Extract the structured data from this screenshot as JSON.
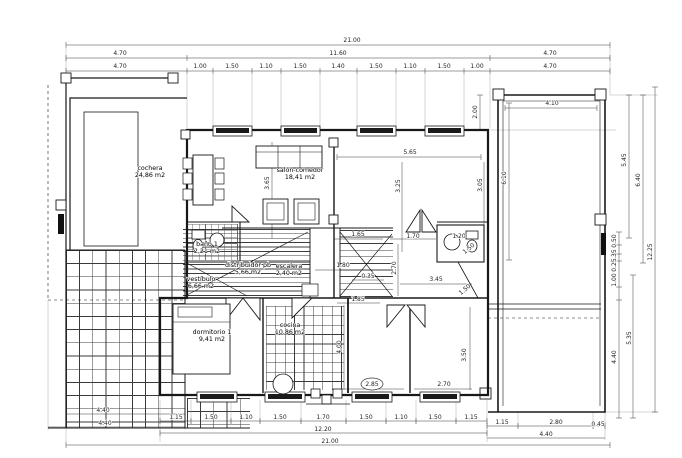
{
  "drawing": {
    "kind": "architectural floor plan, ground floor (planta baja)",
    "line_color": "#181818",
    "background": "#ffffff"
  },
  "rooms": [
    {
      "name": "cochera",
      "area": "24,86 m2",
      "x": 150,
      "y": 170
    },
    {
      "name": "salón-comedor",
      "area": "18,41 m2",
      "x": 300,
      "y": 172
    },
    {
      "name": "baño 1",
      "area": "2,21 m2",
      "x": 207,
      "y": 246
    },
    {
      "name": "distribuidor pb",
      "area": "5,66 m2",
      "x": 248,
      "y": 267
    },
    {
      "name": "vestíbulo",
      "area": "6,66 m2",
      "x": 201,
      "y": 281
    },
    {
      "name": "escalera",
      "area": "2,40 m2",
      "x": 289,
      "y": 268
    },
    {
      "name": "dormitorio 1",
      "area": "9,41 m2",
      "x": 212,
      "y": 334
    },
    {
      "name": "cocina",
      "area": "10,86 m2",
      "x": 290,
      "y": 327
    }
  ],
  "dimension_labels": [
    {
      "t": "21.00",
      "x": 352,
      "y": 42
    },
    {
      "t": "4.70",
      "x": 120,
      "y": 55
    },
    {
      "t": "11.60",
      "x": 338,
      "y": 55
    },
    {
      "t": "4.70",
      "x": 550,
      "y": 55
    },
    {
      "t": "4.70",
      "x": 120,
      "y": 68
    },
    {
      "t": "1.00",
      "x": 200,
      "y": 68
    },
    {
      "t": "1.50",
      "x": 232,
      "y": 68
    },
    {
      "t": "1.10",
      "x": 266,
      "y": 68
    },
    {
      "t": "1.50",
      "x": 300,
      "y": 68
    },
    {
      "t": "1.40",
      "x": 338,
      "y": 68
    },
    {
      "t": "1.50",
      "x": 376,
      "y": 68
    },
    {
      "t": "1.10",
      "x": 410,
      "y": 68
    },
    {
      "t": "1.50",
      "x": 444,
      "y": 68
    },
    {
      "t": "1.00",
      "x": 477,
      "y": 68
    },
    {
      "t": "4.70",
      "x": 550,
      "y": 68
    },
    {
      "t": "2.00",
      "x": 477,
      "y": 112,
      "r": 1
    },
    {
      "t": "4.10",
      "x": 552,
      "y": 105
    },
    {
      "t": "6.10",
      "x": 506,
      "y": 178,
      "r": 1
    },
    {
      "t": "5.45",
      "x": 626,
      "y": 160,
      "r": 1
    },
    {
      "t": "6.40",
      "x": 640,
      "y": 180,
      "r": 1
    },
    {
      "t": "12.25",
      "x": 652,
      "y": 252,
      "r": 1
    },
    {
      "t": "0.50",
      "x": 616,
      "y": 241,
      "r": 1
    },
    {
      "t": "0.35",
      "x": 616,
      "y": 256,
      "r": 1
    },
    {
      "t": "0.25",
      "x": 616,
      "y": 265,
      "r": 1
    },
    {
      "t": "1.00",
      "x": 616,
      "y": 280,
      "r": 1
    },
    {
      "t": "5.35",
      "x": 631,
      "y": 338,
      "r": 1
    },
    {
      "t": "4.40",
      "x": 616,
      "y": 357,
      "r": 1
    },
    {
      "t": "5.65",
      "x": 410,
      "y": 154
    },
    {
      "t": "3.65",
      "x": 269,
      "y": 183,
      "r": 1
    },
    {
      "t": "3.25",
      "x": 400,
      "y": 186,
      "r": 1
    },
    {
      "t": "3.05",
      "x": 482,
      "y": 185,
      "r": 1
    },
    {
      "t": "1.65",
      "x": 358,
      "y": 236
    },
    {
      "t": "1.70",
      "x": 413,
      "y": 238
    },
    {
      "t": "1.20",
      "x": 459,
      "y": 238
    },
    {
      "t": "1.50",
      "x": 470,
      "y": 250,
      "r": 2
    },
    {
      "t": "2.70",
      "x": 396,
      "y": 268,
      "r": 1
    },
    {
      "t": "1.80",
      "x": 343,
      "y": 267
    },
    {
      "t": "0.35",
      "x": 368,
      "y": 278
    },
    {
      "t": "3.45",
      "x": 436,
      "y": 281
    },
    {
      "t": "1.50",
      "x": 466,
      "y": 291,
      "r": 2
    },
    {
      "t": "1.85",
      "x": 358,
      "y": 301
    },
    {
      "t": "4.00",
      "x": 341,
      "y": 347,
      "r": 1
    },
    {
      "t": "3.50",
      "x": 466,
      "y": 355,
      "r": 1
    },
    {
      "t": "2.70",
      "x": 444,
      "y": 386
    },
    {
      "t": "2.85",
      "x": 372,
      "y": 386,
      "c": 1
    },
    {
      "t": "1.15",
      "x": 176,
      "y": 419
    },
    {
      "t": "1.50",
      "x": 211,
      "y": 419
    },
    {
      "t": "1.10",
      "x": 246,
      "y": 419
    },
    {
      "t": "1.50",
      "x": 280,
      "y": 419
    },
    {
      "t": "1.70",
      "x": 323,
      "y": 419
    },
    {
      "t": "1.50",
      "x": 366,
      "y": 419
    },
    {
      "t": "1.10",
      "x": 401,
      "y": 419
    },
    {
      "t": "1.50",
      "x": 435,
      "y": 419
    },
    {
      "t": "1.15",
      "x": 471,
      "y": 419
    },
    {
      "t": "12.20",
      "x": 323,
      "y": 431
    },
    {
      "t": "21.00",
      "x": 330,
      "y": 443
    },
    {
      "t": "4.40",
      "x": 103,
      "y": 412
    },
    {
      "t": "4.40",
      "x": 105,
      "y": 425
    },
    {
      "t": "1.15",
      "x": 502,
      "y": 424
    },
    {
      "t": "2.80",
      "x": 556,
      "y": 424
    },
    {
      "t": "0.45",
      "x": 598,
      "y": 426
    },
    {
      "t": "4.40",
      "x": 546,
      "y": 436
    }
  ]
}
